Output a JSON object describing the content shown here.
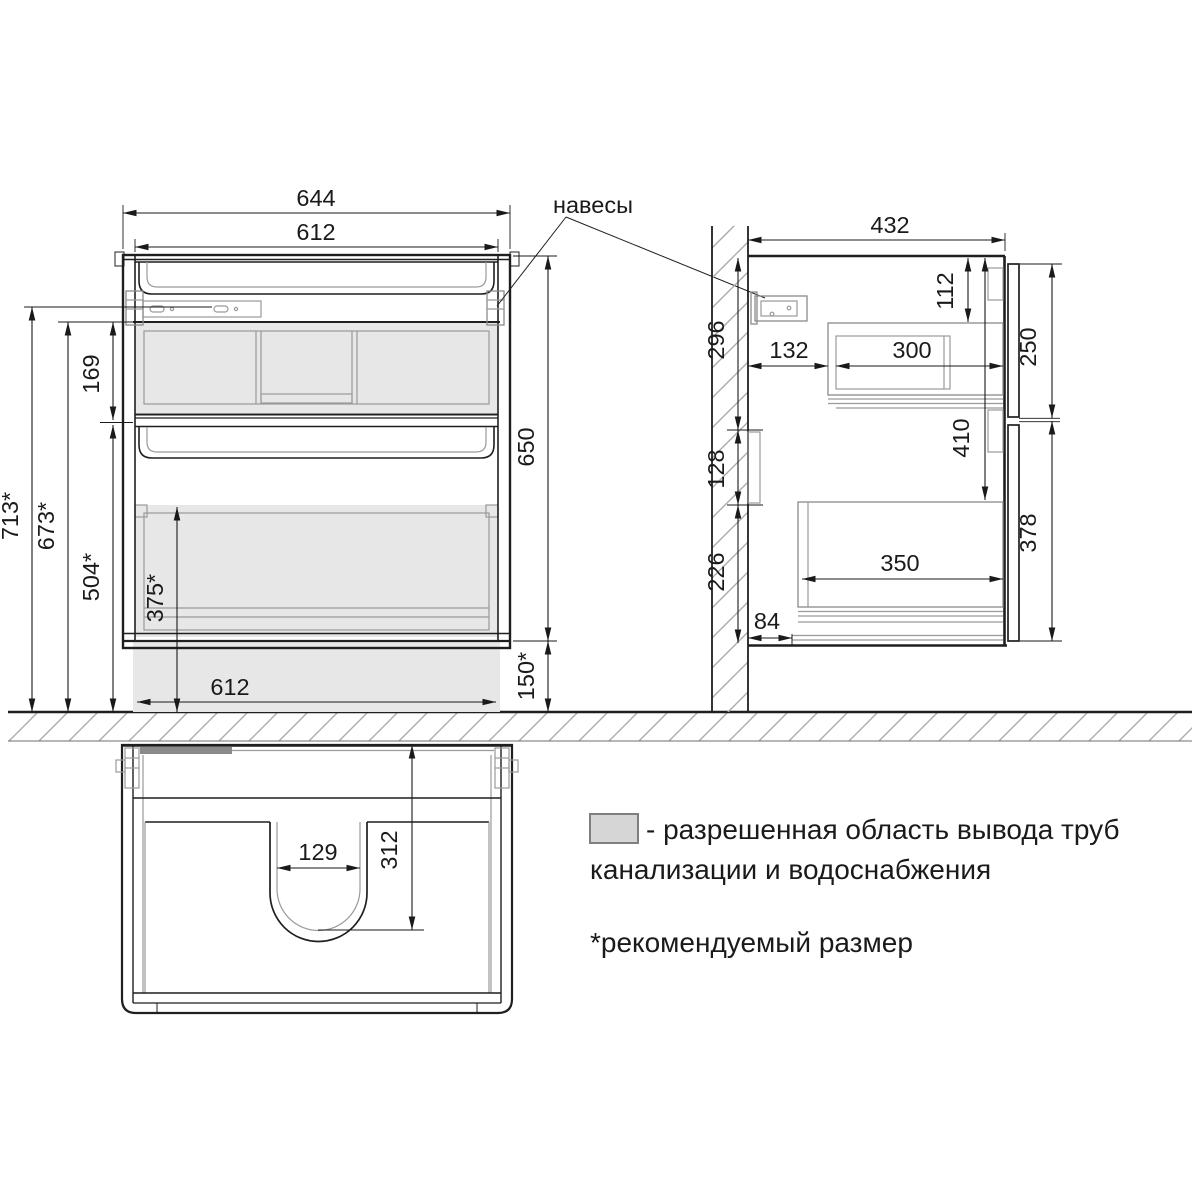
{
  "front_view": {
    "hangers_label": "навесы",
    "dims": {
      "width_outer": "644",
      "width_inner": "612",
      "height": "650",
      "hanger_zone": "169",
      "height_top_recommended": "713*",
      "rail_height_recommended": "673*",
      "divider_height_recommended": "504*",
      "pipe_zone_height_recommended": "375*",
      "floor_gap_recommended": "150*",
      "width_bottom": "612"
    }
  },
  "side_view": {
    "dims": {
      "depth": "432",
      "top_to_drawer_box": "112",
      "wall_upper": "296",
      "wall_to_box": "132",
      "box_depth": "300",
      "top_front_height": "250",
      "top_to_lower_zone": "410",
      "wall_middle": "128",
      "wall_lower": "226",
      "lower_box_depth": "350",
      "bottom_front_height": "378",
      "bottom_inset": "84"
    }
  },
  "bottom_view": {
    "dims": {
      "cutout_width": "129",
      "cutout_depth": "312"
    }
  },
  "legend": {
    "allowed_area_line1": "- разрешенная область вывода труб",
    "allowed_area_line2": "канализации и водоснабжения",
    "recommended_note": "*рекомендуемый размер"
  },
  "colors": {
    "line": "#1f1f1f",
    "detail": "#9a9a9a",
    "area_fill": "#e7e7e7",
    "hatch": "#ababab",
    "legend_fill": "#d6d6d6"
  }
}
